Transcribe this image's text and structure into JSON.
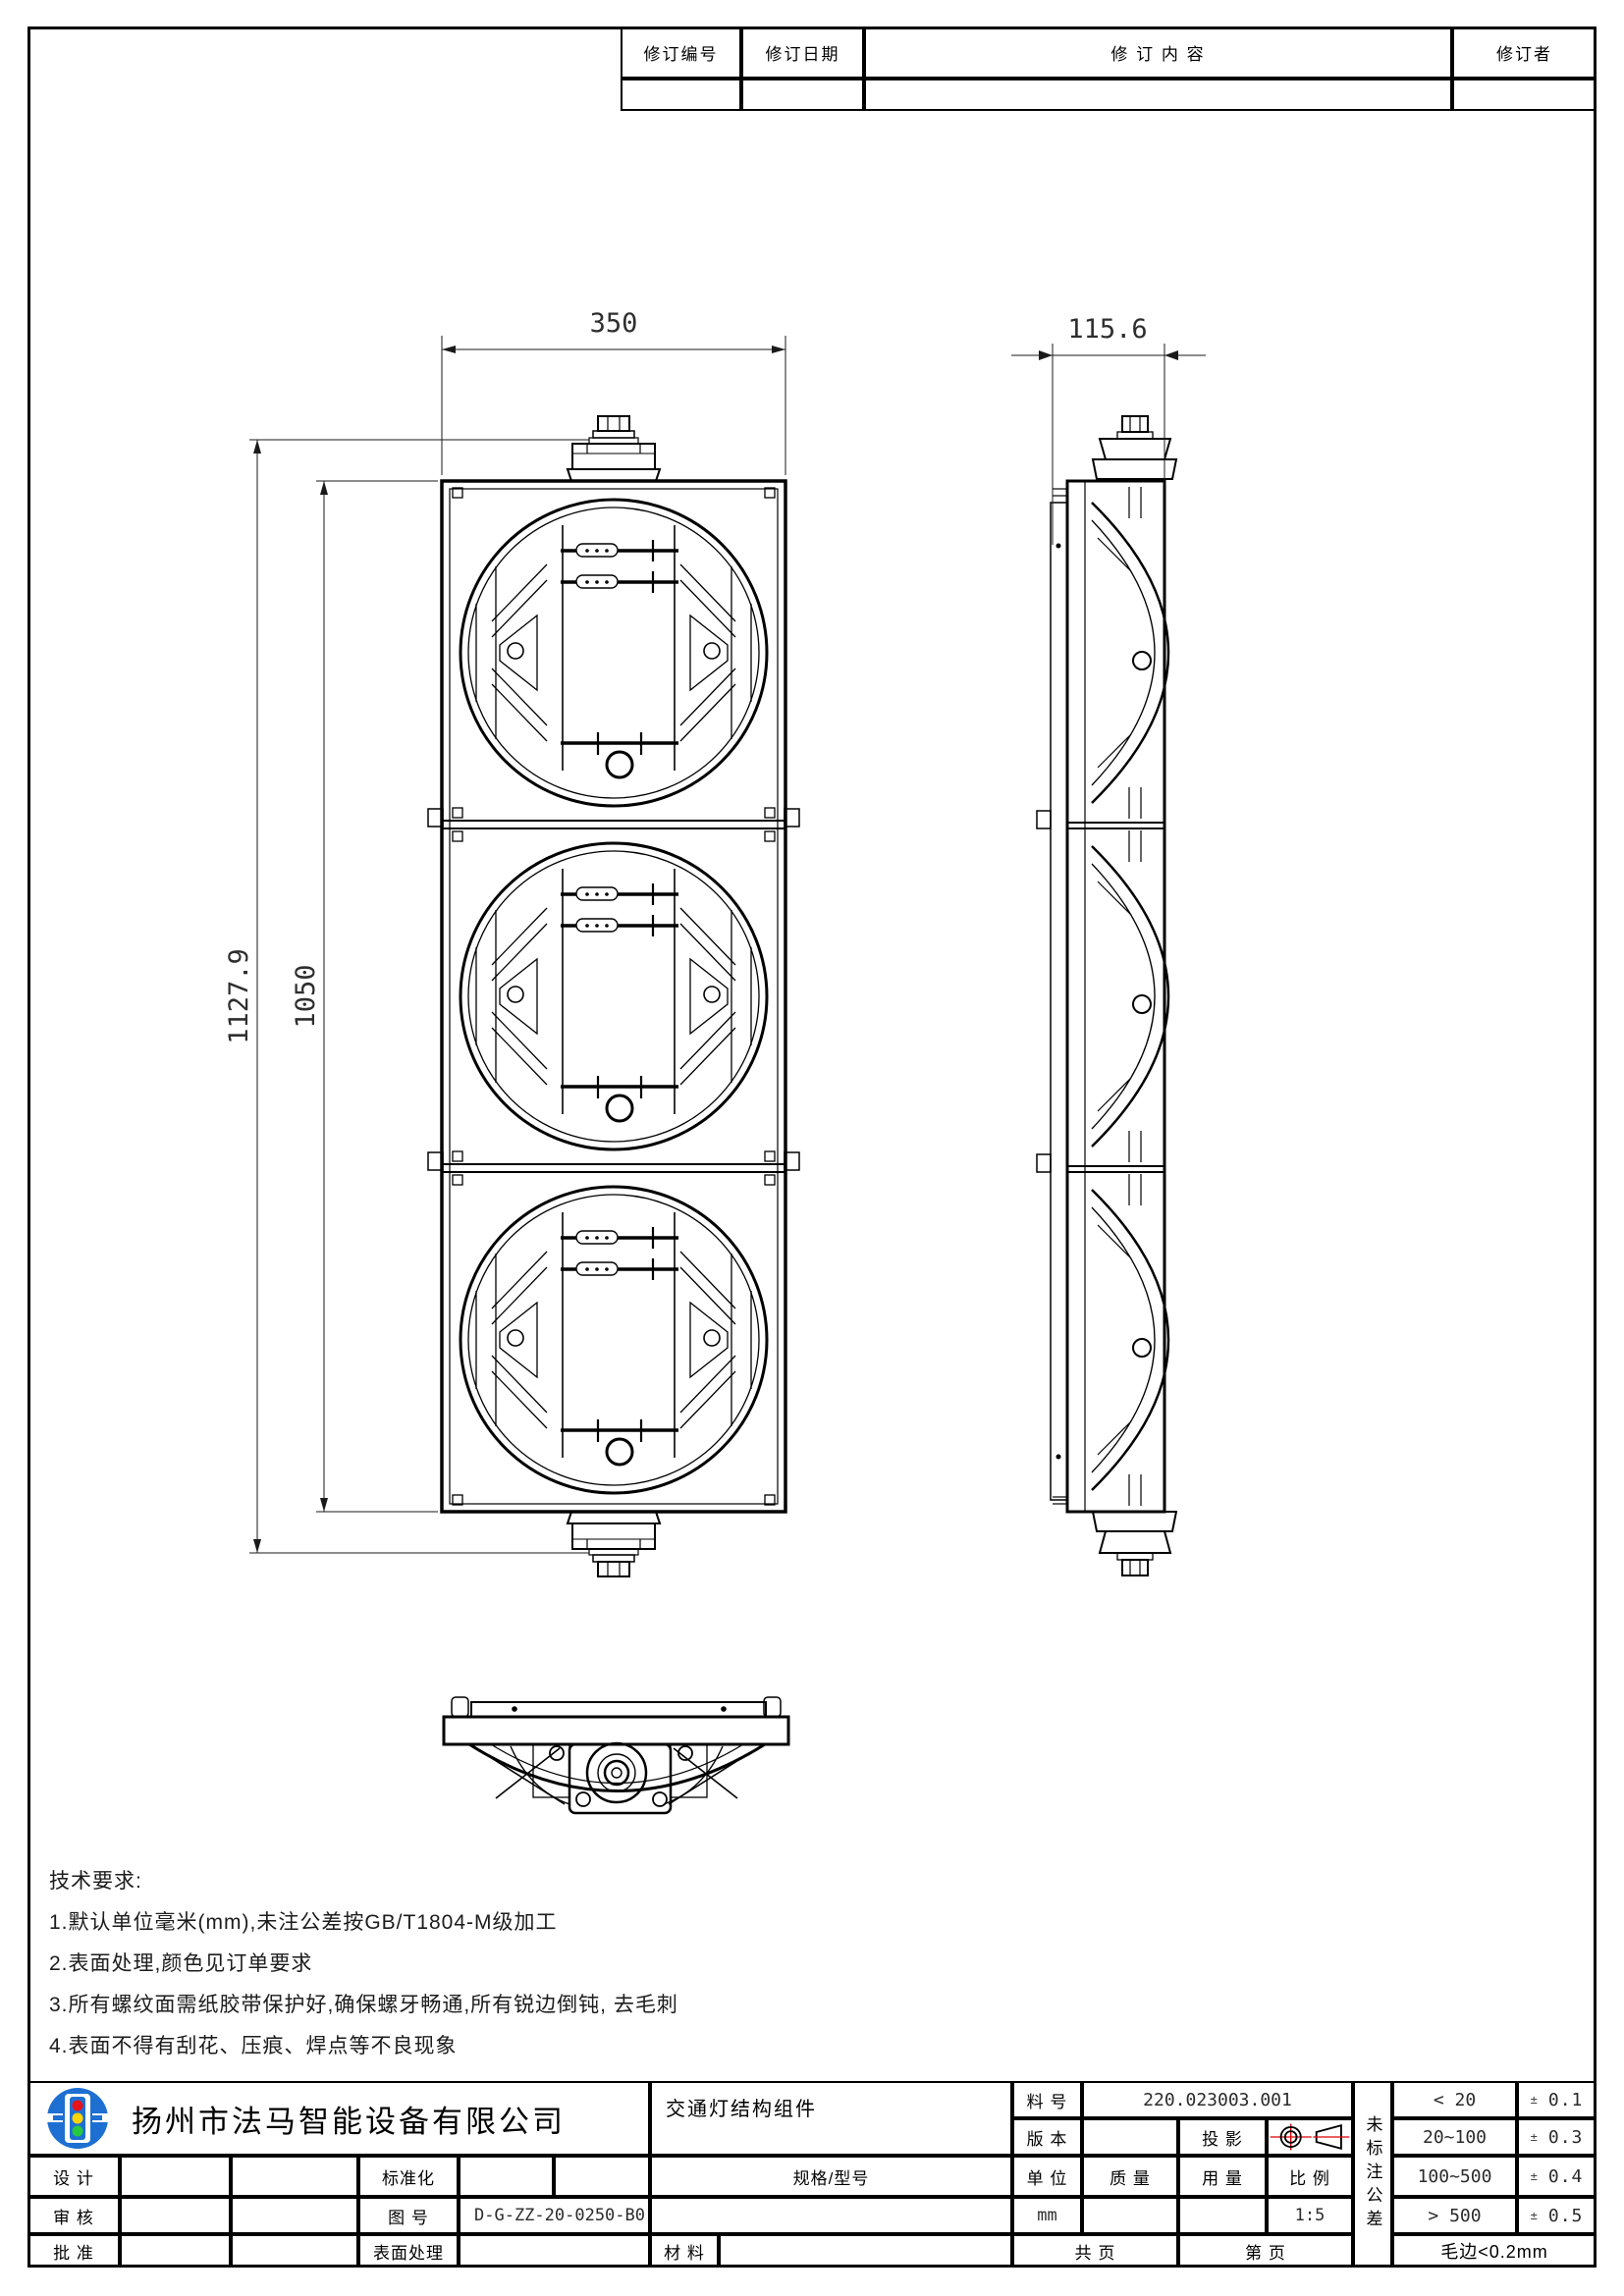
{
  "revision_table": {
    "col_revision_no": "修订编号",
    "col_revision_date": "修订日期",
    "col_revision_content": "修 订 内 容",
    "col_revision_by": "修订者"
  },
  "dimensions": {
    "width": "350",
    "depth": "115.6",
    "total_height": "1127.9",
    "body_height": "1050"
  },
  "technical_requirements": {
    "title": "技术要求:",
    "items": [
      "1.默认单位毫米(mm),未注公差按GB/T1804-M级加工",
      "2.表面处理,颜色见订单要求",
      "3.所有螺纹面需纸胶带保护好,确保螺牙畅通,所有锐边倒钝, 去毛刺",
      "4.表面不得有刮花、压痕、焊点等不良现象"
    ]
  },
  "title_block": {
    "company": "扬州市法马智能设备有限公司",
    "part_name": "交通灯结构组件",
    "labels": {
      "design": "设 计",
      "standardization": "标准化",
      "review": "审 核",
      "drawing_no": "图 号",
      "approve": "批 准",
      "surface": "表面处理",
      "spec": "规格/型号",
      "material": "材 料",
      "part_no": "料 号",
      "version": "版 本",
      "projection": "投 影",
      "unit": "单 位",
      "mass": "质 量",
      "usage": "用 量",
      "scale": "比 例",
      "total_pages": "共  页",
      "page_no": "第  页"
    },
    "values": {
      "part_no": "220.023003.001",
      "drawing_no": "D-G-ZZ-20-0250-B0",
      "unit": "mm",
      "scale": "1:5"
    },
    "tolerance": {
      "side_label": "未标注公差",
      "pm": "±",
      "rows": [
        {
          "range": "< 20",
          "value": "0.1"
        },
        {
          "range": "20~100",
          "value": "0.3"
        },
        {
          "range": "100~500",
          "value": "0.4"
        },
        {
          "range": "> 500",
          "value": "0.5"
        }
      ],
      "burr": "毛边<0.2mm"
    }
  },
  "colors": {
    "line": "#000000",
    "logo_blue": "#1e6fd2",
    "signal_red": "#e8121a",
    "signal_yellow": "#ffd400",
    "signal_green": "#27c93f",
    "centerline_red": "#dd0000"
  }
}
